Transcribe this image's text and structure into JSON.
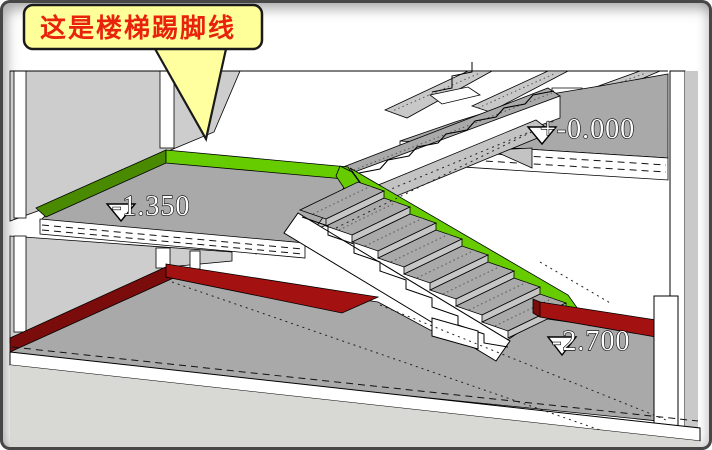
{
  "scene": {
    "callout": {
      "text": "这是楼梯踢脚线",
      "bubble_color": "#FFFF99",
      "tail_color": "#FFFFA0",
      "text_color": "#E8220C",
      "border_color": "#1A1A1A"
    },
    "elevations": [
      {
        "id": "level-top",
        "label": "+-0.000"
      },
      {
        "id": "level-mid",
        "label": "-1.350"
      },
      {
        "id": "level-bottom",
        "label": "-2.700"
      }
    ],
    "materials": {
      "stair_skirting_green_bright": "#66CC00",
      "stair_skirting_green_dark": "#4A8A00",
      "floor_skirting_red_bright": "#A31111",
      "floor_skirting_red_dark": "#7A0C0C",
      "wall_gray": "#CDCDCD",
      "floor_gray": "#A9A9A9",
      "riser_gray": "#C6C6C6",
      "band_gray": "#C8C8C8",
      "stringer_gray": "#C3C3C3",
      "ground_gray": "#D8D8D4",
      "white": "#FFFFFF"
    }
  }
}
